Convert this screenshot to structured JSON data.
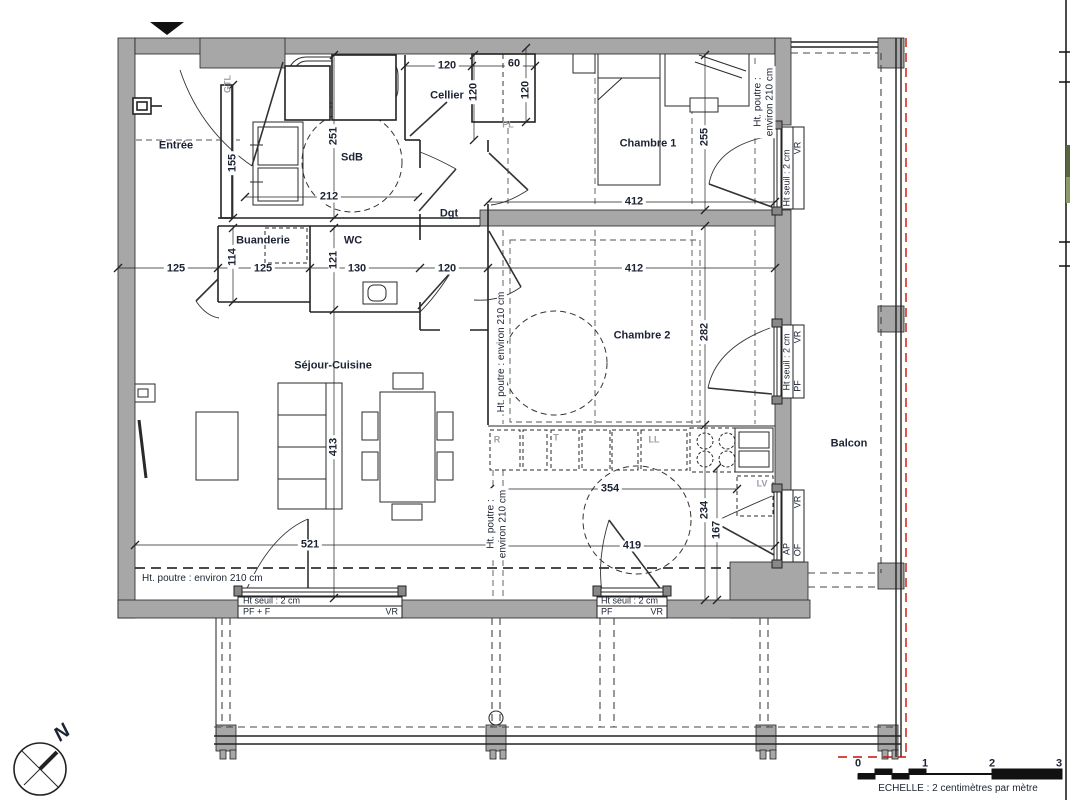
{
  "plan": {
    "rooms": {
      "entree": "Entrée",
      "sdb": "SdB",
      "cellier": "Cellier",
      "chambre1": "Chambre 1",
      "buanderie": "Buanderie",
      "wc": "WC",
      "dgt": "Dgt",
      "chambre2": "Chambre 2",
      "sejour": "Séjour-Cuisine",
      "balcon": "Balcon"
    },
    "dims": {
      "cellier_w": "120",
      "cellier_d": "120",
      "closet_w": "60",
      "closet_d": "120",
      "entree_wall": "155",
      "sdb_turn": "251",
      "sdb_w": "212",
      "chambre1_d": "255",
      "chambre1_w": "412",
      "hall1": "125",
      "buanderie_w": "125",
      "buanderie_d": "114",
      "wc_jog": "121",
      "wc_w": "130",
      "dgt_w": "120",
      "chambre2_w": "412",
      "chambre2_d": "282",
      "sejour_d": "413",
      "sejour_w": "521",
      "kitchen_w": "354",
      "kitchen_d": "234",
      "kitchen_pass": "419",
      "kitchen_side": "167"
    },
    "notes": {
      "beam_full": "Ht. poutre : environ 210 cm",
      "beam_l1": "Ht. poutre :",
      "beam_l2": "environ 210 cm"
    },
    "tags": {
      "gtl": "GTL",
      "pl": "PL",
      "fridge": "R",
      "t": "T",
      "washer": "LL",
      "dishwasher": "LV"
    },
    "windows": {
      "sill": "Ht seuil : 2 cm",
      "bottom_left": {
        "type": "PF + F",
        "shutter": "VR"
      },
      "bottom_mid": {
        "type": "PF",
        "shutter": "VR"
      },
      "right_top": {
        "shutter": "VR"
      },
      "right_mid": {
        "shutter": "VR",
        "type": "PF"
      },
      "right_bottom": {
        "shutter": "VR",
        "ap": "AP",
        "of": "OF"
      }
    },
    "compass": {
      "north": "N"
    },
    "scale": {
      "ticks": [
        "0",
        "1",
        "2",
        "3"
      ],
      "caption": "ECHELLE : 2 centimètres par mètre"
    },
    "colors": {
      "wall": "#a7a7a7",
      "line": "#222222",
      "red": "#cc1100"
    }
  }
}
